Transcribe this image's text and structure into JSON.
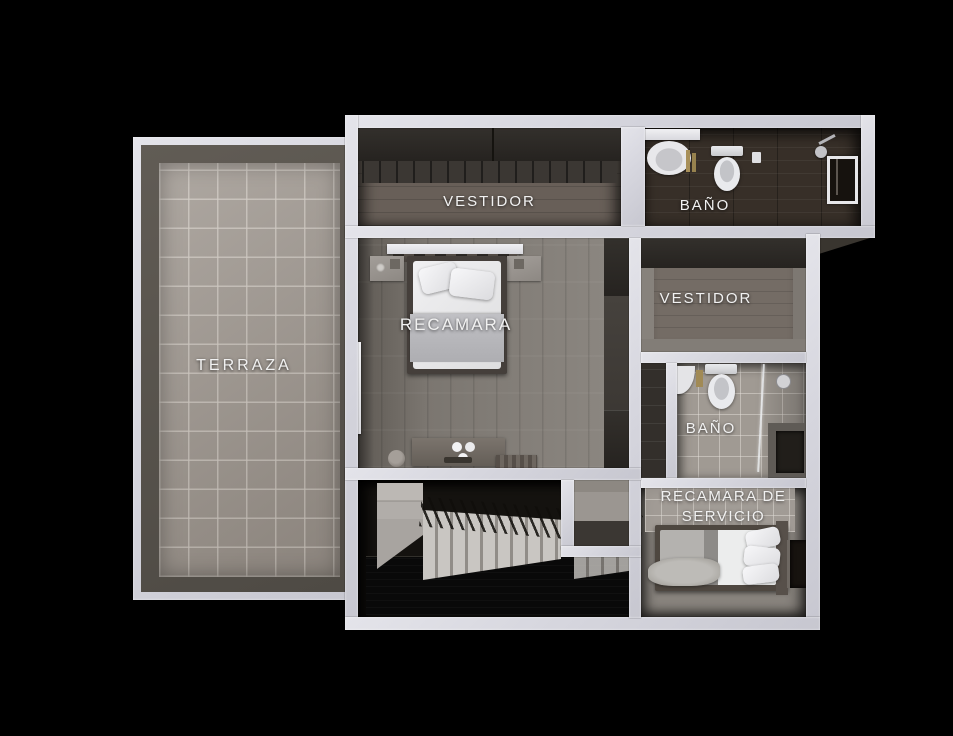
{
  "canvas": {
    "width": 953,
    "height": 736,
    "background": "#000000"
  },
  "palette": {
    "wall": "#d6d6de",
    "label_color": "#f1f1f1",
    "terrace_tile": "#9a928a",
    "bedroom_floor": "#7b7670",
    "dark_bath_floor": "#372f28",
    "stair_void": "#090909"
  },
  "rooms": {
    "terraza": {
      "label": "TERRAZA"
    },
    "vestidor_principal": {
      "label": "VESTIDOR"
    },
    "bano_principal": {
      "label": "BAÑO"
    },
    "recamara": {
      "label": "RECAMARA"
    },
    "vestidor_secundario": {
      "label": "VESTIDOR"
    },
    "bano_secundario": {
      "label": "BAÑO"
    },
    "recamara_servicio": {
      "label": "RECAMARA DE SERVICIO"
    }
  }
}
